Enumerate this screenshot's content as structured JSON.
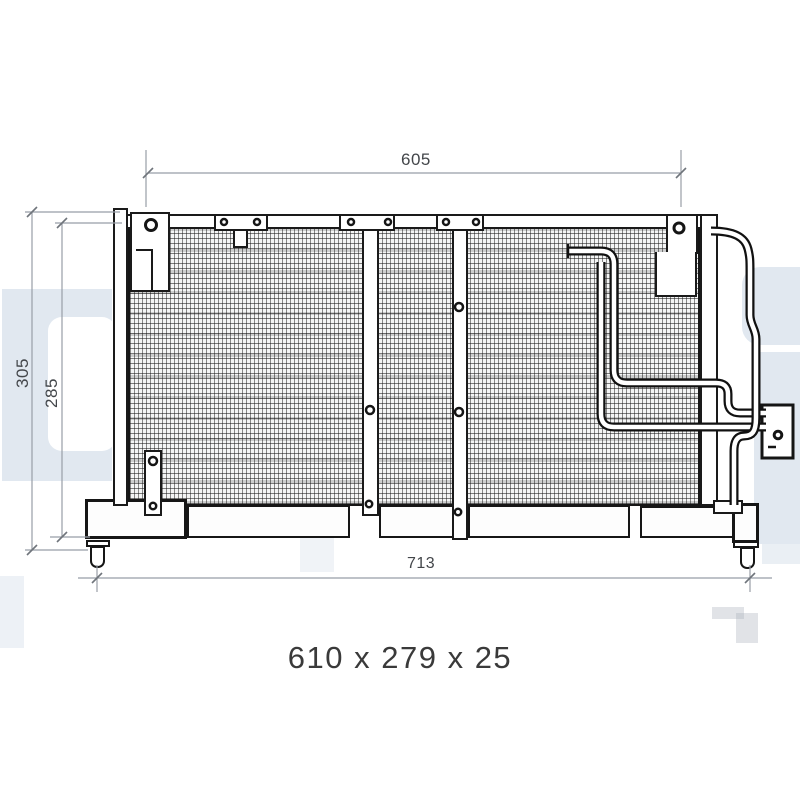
{
  "drawing": {
    "type": "condenser-technical-drawing",
    "dimensions": {
      "top_width": "605",
      "overall_height": "305",
      "core_height": "285",
      "bottom_width": "713"
    },
    "caption": "610 x 279 x 25",
    "colors": {
      "line": "#1a1a1a",
      "dimension_line": "#989ea6",
      "dimension_text": "#43464a",
      "watermark": "#e1e8f0"
    }
  }
}
